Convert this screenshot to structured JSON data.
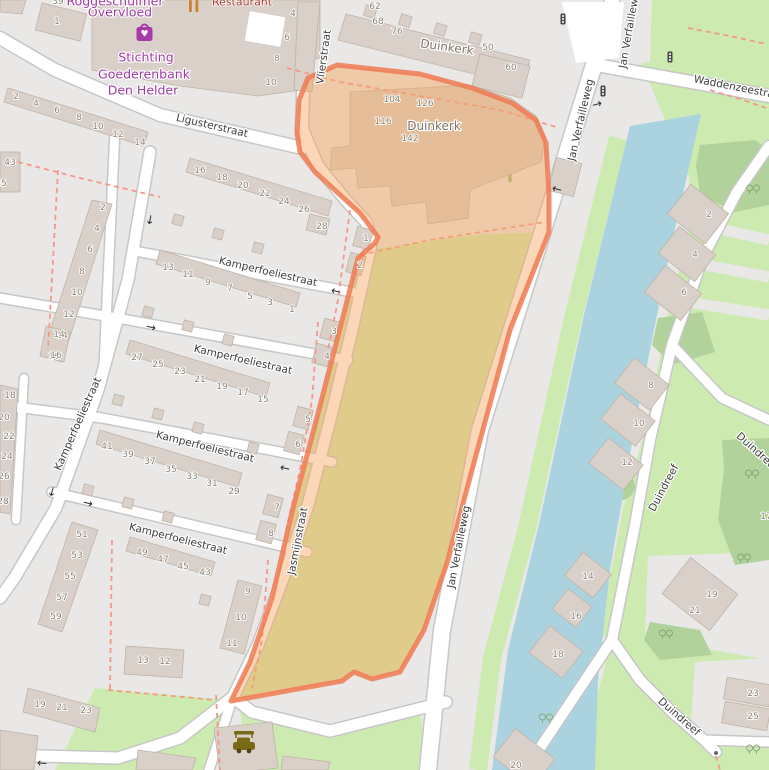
{
  "map": {
    "type": "openstreetmap-carto",
    "selected_feature": "Duinkerk parcel",
    "colors": {
      "residential": "#e9e8e6",
      "grass": "#cdebb0",
      "scrub": "#b1d29a",
      "water": "#aad3df",
      "building": "#d9d0c9",
      "building_outline": "#bfb4a6",
      "road_fill": "#ffffff",
      "road_casing": "#c7c7c7",
      "footpath_dashed": "#f5988a",
      "selection_fill": "#f7a45c",
      "selection_stroke": "#ee7a52",
      "shop_purple": "#a03ba5",
      "amenity_red": "#a33b2b",
      "hedge": "#90bb6e"
    }
  },
  "labels": [
    {
      "n": "street-label-ligusterstraat",
      "t": "Ligusterstraat",
      "x": 212,
      "y": 126,
      "r": 13,
      "k": "street"
    },
    {
      "n": "street-label-vlierstraat",
      "t": "Vlierstraat",
      "x": 324,
      "y": 57,
      "r": -82,
      "k": "street"
    },
    {
      "n": "street-label-kamperfoeliestraat-vertical",
      "t": "Kamperfoeliestraat",
      "x": 78,
      "y": 424,
      "r": -66,
      "k": "street"
    },
    {
      "n": "street-label-kamperfoeliestraat-1",
      "t": "Kamperfoeliestraat",
      "x": 268,
      "y": 272,
      "r": 13,
      "k": "street"
    },
    {
      "n": "street-label-kamperfoeliestraat-2",
      "t": "Kamperfoeliestraat",
      "x": 243,
      "y": 360,
      "r": 13,
      "k": "street"
    },
    {
      "n": "street-label-kamperfoeliestraat-3",
      "t": "Kamperfoeliestraat",
      "x": 205,
      "y": 447,
      "r": 14,
      "k": "street"
    },
    {
      "n": "street-label-kamperfoeliestraat-4",
      "t": "Kamperfoeliestraat",
      "x": 178,
      "y": 539,
      "r": 14,
      "k": "street"
    },
    {
      "n": "street-label-jasmijnstraat",
      "t": "Jasmijnstraat",
      "x": 298,
      "y": 541,
      "r": -79,
      "k": "street"
    },
    {
      "n": "street-label-jan-verfailleweg-top",
      "t": "Jan Verfailleweg",
      "x": 581,
      "y": 120,
      "r": -77,
      "k": "street"
    },
    {
      "n": "street-label-jan-verfailleweg-mid",
      "t": "Jan Verfailleweg",
      "x": 459,
      "y": 547,
      "r": -79,
      "k": "street"
    },
    {
      "n": "street-label-duindreef-upper",
      "t": "Duindreef",
      "x": 664,
      "y": 488,
      "r": -62,
      "k": "street"
    },
    {
      "n": "street-label-duindreef-lower",
      "t": "Duindreef",
      "x": 679,
      "y": 717,
      "r": 41,
      "k": "street"
    },
    {
      "n": "street-label-waddenzeestraat-clipped",
      "t": "Waddenzeestraat",
      "x": 739,
      "y": 88,
      "r": 11,
      "k": "street",
      "a": "start"
    },
    {
      "n": "street-label-jan-verfailleweg-clipped",
      "t": "Jan Verfailleweg",
      "x": 630,
      "y": 27,
      "r": -80,
      "k": "street",
      "a": "start"
    },
    {
      "n": "street-label-duindreef-clipped",
      "t": "Duindreef",
      "x": 757,
      "y": 452,
      "r": 42,
      "k": "street",
      "a": "start"
    },
    {
      "n": "area-label-duinkerk-north",
      "t": "Duinkerk",
      "x": 447,
      "y": 47,
      "r": 8,
      "k": "area"
    },
    {
      "n": "area-label-duinkerk-selected",
      "t": "Duinkerk",
      "x": 434,
      "y": 126,
      "r": 0,
      "k": "area"
    },
    {
      "n": "poi-label-overvloed",
      "t": "Overvloed",
      "x": 120,
      "y": 12,
      "r": 0,
      "k": "purple"
    },
    {
      "n": "poi-label-overvloed-line1-clipped",
      "t": "Roggeschuimer",
      "x": 115,
      "y": 1,
      "r": 0,
      "k": "purple"
    },
    {
      "n": "poi-label-stichting-line1",
      "t": "Stichting",
      "x": 146,
      "y": 57,
      "r": 0,
      "k": "purple"
    },
    {
      "n": "poi-label-stichting-line2",
      "t": "Goederenbank",
      "x": 144,
      "y": 74,
      "r": 0,
      "k": "purple"
    },
    {
      "n": "poi-label-stichting-line3",
      "t": "Den Helder",
      "x": 143,
      "y": 90,
      "r": 0,
      "k": "purple"
    },
    {
      "n": "poi-label-restaurant-clipped",
      "t": "Restaurant",
      "x": 242,
      "y": 2,
      "r": 0,
      "k": "red"
    },
    {
      "t": "2",
      "x": 16,
      "y": 97,
      "k": "house"
    },
    {
      "t": "4",
      "x": 36,
      "y": 104,
      "k": "house"
    },
    {
      "t": "6",
      "x": 57,
      "y": 111,
      "k": "house"
    },
    {
      "t": "8",
      "x": 79,
      "y": 118,
      "k": "house"
    },
    {
      "t": "10",
      "x": 98,
      "y": 127,
      "k": "house"
    },
    {
      "t": "12",
      "x": 118,
      "y": 135,
      "k": "house"
    },
    {
      "t": "14",
      "x": 140,
      "y": 143,
      "k": "house"
    },
    {
      "t": "1",
      "x": 57,
      "y": 22,
      "k": "house"
    },
    {
      "t": "39",
      "x": 58,
      "y": 2,
      "k": "house"
    },
    {
      "t": "4",
      "x": 293,
      "y": 14,
      "k": "house"
    },
    {
      "t": "6",
      "x": 287,
      "y": 38,
      "k": "house"
    },
    {
      "t": "8",
      "x": 277,
      "y": 59,
      "k": "house"
    },
    {
      "t": "10",
      "x": 271,
      "y": 83,
      "k": "house"
    },
    {
      "t": "43",
      "x": 10,
      "y": 163,
      "k": "house"
    },
    {
      "t": "45",
      "x": 1,
      "y": 184,
      "k": "house"
    },
    {
      "t": "2",
      "x": 103,
      "y": 208,
      "k": "house"
    },
    {
      "t": "4",
      "x": 97,
      "y": 229,
      "k": "house"
    },
    {
      "t": "6",
      "x": 90,
      "y": 250,
      "k": "house"
    },
    {
      "t": "8",
      "x": 82,
      "y": 272,
      "k": "house"
    },
    {
      "t": "10",
      "x": 77,
      "y": 293,
      "k": "house"
    },
    {
      "t": "12",
      "x": 69,
      "y": 315,
      "k": "house"
    },
    {
      "t": "14",
      "x": 62,
      "y": 336,
      "k": "house"
    },
    {
      "t": "16",
      "x": 54,
      "y": 357,
      "k": "house"
    },
    {
      "t": "16",
      "x": 200,
      "y": 171,
      "k": "house"
    },
    {
      "t": "18",
      "x": 222,
      "y": 178,
      "k": "house"
    },
    {
      "t": "20",
      "x": 243,
      "y": 186,
      "k": "house"
    },
    {
      "t": "22",
      "x": 265,
      "y": 194,
      "k": "house"
    },
    {
      "t": "24",
      "x": 284,
      "y": 202,
      "k": "house"
    },
    {
      "t": "26",
      "x": 304,
      "y": 210,
      "k": "house"
    },
    {
      "t": "28",
      "x": 322,
      "y": 227,
      "k": "house"
    },
    {
      "t": "13",
      "x": 168,
      "y": 268,
      "k": "house"
    },
    {
      "t": "11",
      "x": 188,
      "y": 275,
      "k": "house"
    },
    {
      "t": "9",
      "x": 208,
      "y": 283,
      "k": "house"
    },
    {
      "t": "7",
      "x": 230,
      "y": 289,
      "k": "house"
    },
    {
      "t": "5",
      "x": 250,
      "y": 297,
      "k": "house"
    },
    {
      "t": "3",
      "x": 270,
      "y": 303,
      "k": "house"
    },
    {
      "t": "1",
      "x": 292,
      "y": 310,
      "k": "house"
    },
    {
      "t": "1",
      "x": 366,
      "y": 239,
      "k": "house"
    },
    {
      "t": "2",
      "x": 360,
      "y": 266,
      "k": "house"
    },
    {
      "t": "3",
      "x": 334,
      "y": 332,
      "k": "house"
    },
    {
      "t": "4",
      "x": 327,
      "y": 357,
      "k": "house"
    },
    {
      "t": "5",
      "x": 308,
      "y": 420,
      "k": "house"
    },
    {
      "t": "6",
      "x": 298,
      "y": 445,
      "k": "house"
    },
    {
      "t": "7",
      "x": 277,
      "y": 508,
      "k": "house"
    },
    {
      "t": "8",
      "x": 271,
      "y": 534,
      "k": "house"
    },
    {
      "t": "9",
      "x": 248,
      "y": 592,
      "k": "house"
    },
    {
      "t": "10",
      "x": 241,
      "y": 618,
      "k": "house"
    },
    {
      "t": "11",
      "x": 232,
      "y": 644,
      "k": "house"
    },
    {
      "t": "27",
      "x": 137,
      "y": 358,
      "k": "house"
    },
    {
      "t": "25",
      "x": 158,
      "y": 365,
      "k": "house"
    },
    {
      "t": "23",
      "x": 180,
      "y": 372,
      "k": "house"
    },
    {
      "t": "21",
      "x": 200,
      "y": 380,
      "k": "house"
    },
    {
      "t": "19",
      "x": 222,
      "y": 387,
      "k": "house"
    },
    {
      "t": "17",
      "x": 243,
      "y": 393,
      "k": "house"
    },
    {
      "t": "15",
      "x": 263,
      "y": 400,
      "k": "house"
    },
    {
      "t": "41",
      "x": 107,
      "y": 447,
      "k": "house"
    },
    {
      "t": "39",
      "x": 128,
      "y": 455,
      "k": "house"
    },
    {
      "t": "37",
      "x": 150,
      "y": 462,
      "k": "house"
    },
    {
      "t": "35",
      "x": 171,
      "y": 470,
      "k": "house"
    },
    {
      "t": "33",
      "x": 192,
      "y": 477,
      "k": "house"
    },
    {
      "t": "31",
      "x": 212,
      "y": 484,
      "k": "house"
    },
    {
      "t": "29",
      "x": 234,
      "y": 492,
      "k": "house"
    },
    {
      "t": "14",
      "x": 59,
      "y": 335,
      "k": "house"
    },
    {
      "t": "16",
      "x": 56,
      "y": 356,
      "k": "house"
    },
    {
      "t": "18",
      "x": 10,
      "y": 396,
      "k": "house"
    },
    {
      "t": "20",
      "x": 4,
      "y": 418,
      "k": "house"
    },
    {
      "t": "22",
      "x": 9,
      "y": 437,
      "k": "house"
    },
    {
      "t": "24",
      "x": 7,
      "y": 457,
      "k": "house"
    },
    {
      "t": "26",
      "x": 4,
      "y": 477,
      "k": "house"
    },
    {
      "t": "28",
      "x": 3,
      "y": 502,
      "k": "house"
    },
    {
      "t": "49",
      "x": 142,
      "y": 553,
      "k": "house"
    },
    {
      "t": "47",
      "x": 163,
      "y": 560,
      "k": "house"
    },
    {
      "t": "45",
      "x": 183,
      "y": 567,
      "k": "house"
    },
    {
      "t": "43",
      "x": 205,
      "y": 573,
      "k": "house"
    },
    {
      "t": "51",
      "x": 82,
      "y": 535,
      "k": "house"
    },
    {
      "t": "53",
      "x": 77,
      "y": 556,
      "k": "house"
    },
    {
      "t": "55",
      "x": 70,
      "y": 577,
      "k": "house"
    },
    {
      "t": "57",
      "x": 62,
      "y": 598,
      "k": "house"
    },
    {
      "t": "59",
      "x": 56,
      "y": 617,
      "k": "house"
    },
    {
      "t": "13",
      "x": 143,
      "y": 661,
      "k": "house"
    },
    {
      "t": "12",
      "x": 165,
      "y": 662,
      "k": "house"
    },
    {
      "t": "19",
      "x": 40,
      "y": 705,
      "k": "house"
    },
    {
      "t": "21",
      "x": 62,
      "y": 708,
      "k": "house"
    },
    {
      "t": "23",
      "x": 86,
      "y": 711,
      "k": "house"
    },
    {
      "t": "62",
      "x": 375,
      "y": 7,
      "k": "house"
    },
    {
      "t": "68",
      "x": 378,
      "y": 22,
      "k": "house"
    },
    {
      "t": "76",
      "x": 397,
      "y": 32,
      "k": "house"
    },
    {
      "t": "50",
      "x": 488,
      "y": 48,
      "k": "house"
    },
    {
      "t": "60",
      "x": 511,
      "y": 68,
      "k": "house"
    },
    {
      "t": "104",
      "x": 392,
      "y": 100,
      "k": "house"
    },
    {
      "t": "126",
      "x": 425,
      "y": 104,
      "k": "house"
    },
    {
      "t": "116",
      "x": 383,
      "y": 122,
      "k": "house"
    },
    {
      "t": "142",
      "x": 410,
      "y": 139,
      "k": "house"
    },
    {
      "t": "2",
      "x": 709,
      "y": 215,
      "k": "house"
    },
    {
      "t": "4",
      "x": 695,
      "y": 255,
      "k": "house"
    },
    {
      "t": "6",
      "x": 684,
      "y": 293,
      "k": "house"
    },
    {
      "t": "8",
      "x": 651,
      "y": 386,
      "k": "house"
    },
    {
      "t": "10",
      "x": 639,
      "y": 424,
      "k": "house"
    },
    {
      "t": "12",
      "x": 627,
      "y": 463,
      "k": "house"
    },
    {
      "t": "14",
      "x": 588,
      "y": 577,
      "k": "house"
    },
    {
      "t": "16",
      "x": 576,
      "y": 617,
      "k": "house"
    },
    {
      "t": "17",
      "x": 766,
      "y": 517,
      "k": "house"
    },
    {
      "t": "19",
      "x": 712,
      "y": 595,
      "k": "house"
    },
    {
      "t": "21",
      "x": 695,
      "y": 611,
      "k": "house"
    },
    {
      "t": "18",
      "x": 558,
      "y": 655,
      "k": "house"
    },
    {
      "t": "20",
      "x": 516,
      "y": 766,
      "k": "house"
    },
    {
      "t": "23",
      "x": 753,
      "y": 694,
      "k": "house"
    },
    {
      "t": "25",
      "x": 753,
      "y": 717,
      "k": "house"
    }
  ],
  "arrows": [
    {
      "g": "←",
      "x": 336,
      "y": 291,
      "r": 13
    },
    {
      "g": "→",
      "x": 151,
      "y": 327,
      "r": 13
    },
    {
      "g": "←",
      "x": 285,
      "y": 468,
      "r": 14
    },
    {
      "g": "→",
      "x": 88,
      "y": 503,
      "r": 14
    },
    {
      "g": "↓",
      "x": 52,
      "y": 492,
      "r": 15
    },
    {
      "g": "↓",
      "x": 150,
      "y": 220,
      "r": 12
    },
    {
      "g": "←",
      "x": 557,
      "y": 189,
      "r": 15
    },
    {
      "g": "→",
      "x": 597,
      "y": 104,
      "r": -15
    },
    {
      "g": "←",
      "x": 42,
      "y": 763,
      "r": 4
    }
  ],
  "icons": [
    {
      "name": "charity-shop-icon"
    },
    {
      "name": "restaurant-icon"
    },
    {
      "name": "car-wash-icon"
    },
    {
      "name": "traffic-signal-icon"
    },
    {
      "name": "bollard-icon"
    },
    {
      "name": "tree-pair-icon"
    }
  ]
}
